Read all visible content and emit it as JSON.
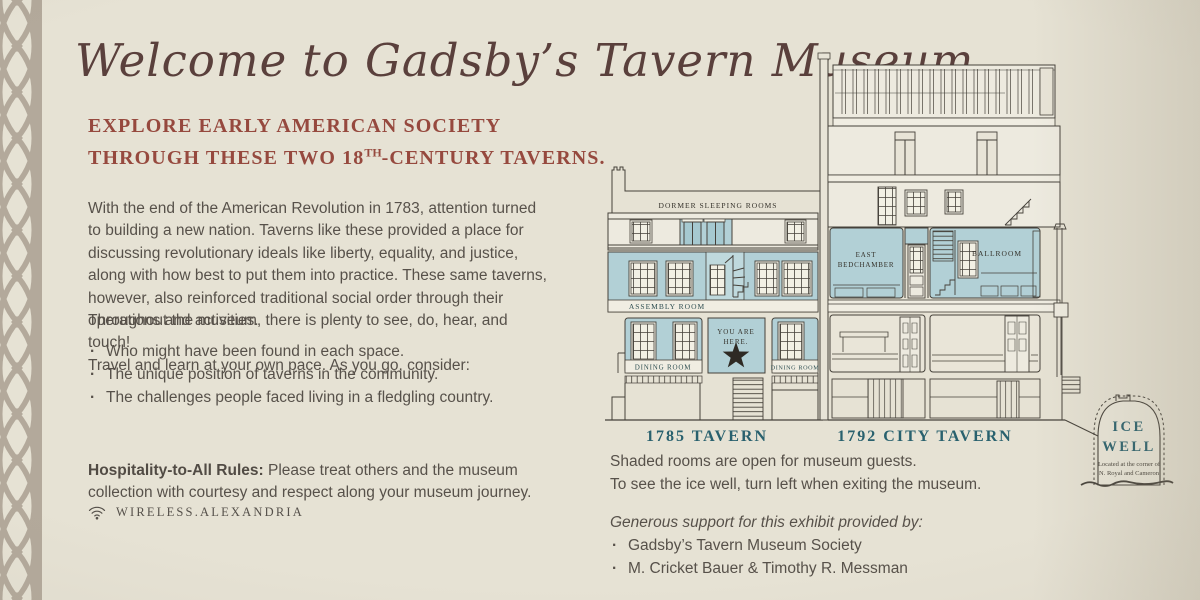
{
  "poster": {
    "title": "Welcome to Gadsby’s Tavern Museum",
    "heading": {
      "line1": "EXPLORE EARLY AMERICAN SOCIETY",
      "line2_pre": "THROUGH THESE TWO 18",
      "line2_sup": "TH",
      "line2_post": "-CENTURY TAVERNS."
    },
    "paragraph1": "With the end of the American Revolution in 1783, attention turned to building a new nation. Taverns like these provided a place for discussing revolutionary ideals like liberty, equality, and justice, along with how best to put them into practice. These same taverns, however, also reinforced traditional social order through their operations and activities.",
    "paragraph2": {
      "line1": "Throughout the museum, there is plenty to see, do, hear, and touch!",
      "line2": "Travel and learn at your own pace. As you go, consider:"
    },
    "bullets": [
      "Who might have been found in each space.",
      "The unique position of taverns in the community.",
      "The challenges people faced living in a fledgling country."
    ],
    "hospitality": {
      "lead": "Hospitality-to-All Rules:",
      "rest": " Please treat others and the museum collection with courtesy and respect along your museum journey."
    },
    "wifi_label": "WIRELESS.ALEXANDRIA"
  },
  "diagram": {
    "labels": {
      "dormer": "DORMER SLEEPING ROOMS",
      "assembly": "ASSEMBLY ROOM",
      "dining_left": "DINING ROOM",
      "dining_right": "DINING ROOM",
      "you_are": "YOU ARE",
      "here": "HERE.",
      "east": "EAST",
      "bedchamber": "BEDCHAMBER",
      "ballroom": "BALLROOM",
      "caption_left": "1785 TAVERN",
      "caption_right": "1792 CITY TAVERN",
      "ice_line1": "ICE",
      "ice_line2": "WELL",
      "ice_note1": "Located at the corner of",
      "ice_note2": "N. Royal and Cameron"
    }
  },
  "footer": {
    "shaded_line1": "Shaded rooms are open for museum guests.",
    "shaded_line2": "To see the ice well, turn left when exiting the museum.",
    "support_heading": "Generous support for this exhibit provided by:",
    "supporters": [
      "Gadsby’s Tavern Museum Society",
      "M. Cricket Bauer & Timothy R. Messman"
    ]
  },
  "icons": {
    "wifi": "wifi-icon",
    "star": "you-are-here-star-icon"
  },
  "colors": {
    "background": "#e6e2d4",
    "room_shade": "#b2d0d6",
    "accent_teal": "#29616e",
    "accent_red": "#96493e",
    "title_brown": "#5a403c",
    "drawing_line": "#45413a",
    "border_taupe": "#b3a99b"
  }
}
